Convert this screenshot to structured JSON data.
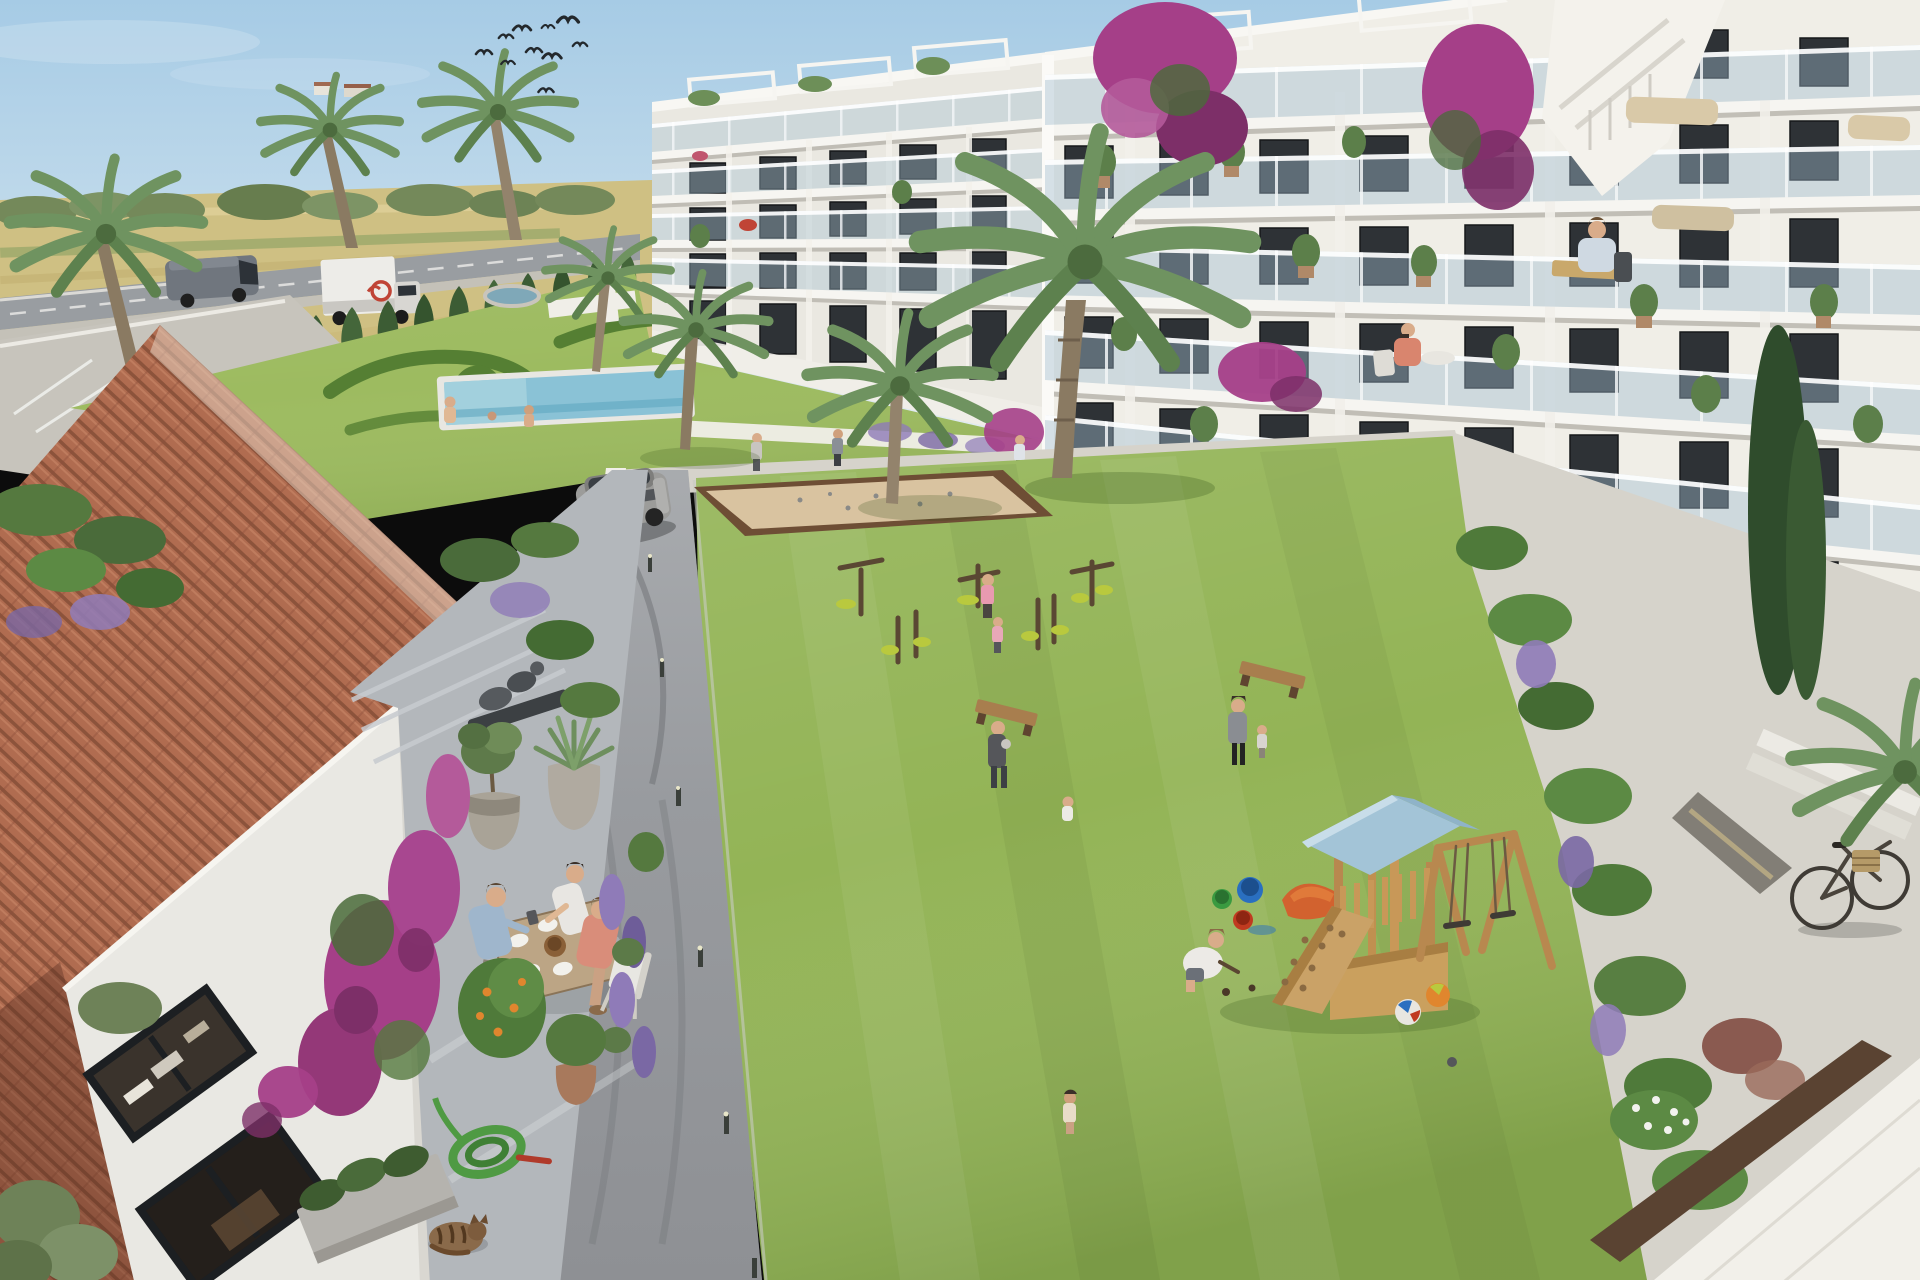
{
  "scene": {
    "type": "architectural-render",
    "setting": "aerial view of a modern white apartment complex courtyard with pool, playground and traditional tiled-roof house",
    "palette": {
      "sky": "#aed0e6",
      "skyHorizon": "#e6edf2",
      "field": "#cfc083",
      "fieldLight": "#decf9a",
      "treeline": "#74895a",
      "road": "#999da1",
      "parking": "#c7c4bc",
      "cypress": "#3c5c34",
      "gardenLawn": "#9dbb60",
      "hedge": "#557f33",
      "poolWater": "#8ac2d6",
      "facade": "#f0eee7",
      "facadeLeft": "#eae8e1",
      "slab": "#f8f7f3",
      "glass": "#a9c3d2",
      "windowDark": "#2e3236",
      "roofTile": "#b06c50",
      "wallWhite": "#e9e8e3",
      "terracePaving": "#b3b7bb",
      "pavingLight": "#d6d3cb",
      "courtLawn": "#93b456",
      "path": "#97999d",
      "sand": "#d9c3a0",
      "sandBorder": "#6e4e35",
      "wood": "#c0935c",
      "playRoof": "#a3c4d7",
      "slideOrange": "#d2622f",
      "bougainvillea": "#a53f88",
      "lavender": "#8f7bb8",
      "truckWhite": "#edece8",
      "vanGray": "#70767e",
      "carRed": "#c23527",
      "suvSilver": "#9c9c9a",
      "skin": "#d9ac8a",
      "catBrown": "#8a6a4a",
      "hoseGreen": "#4f9a43",
      "bikeDark": "#3f3b35",
      "statueGray": "#565a5e"
    },
    "objects": [
      {
        "name": "apartment-building-right"
      },
      {
        "name": "apartment-building-left-wing"
      },
      {
        "name": "traditional-house-terracotta-roof"
      },
      {
        "name": "swimming-pool"
      },
      {
        "name": "garden-pond"
      },
      {
        "name": "petanque-court"
      },
      {
        "name": "playground-tower-with-slide"
      },
      {
        "name": "swing-set"
      },
      {
        "name": "outdoor-gym-equipment"
      },
      {
        "name": "wooden-benches"
      },
      {
        "name": "dining-table-scene"
      },
      {
        "name": "statue"
      },
      {
        "name": "potted-olive-and-agave"
      },
      {
        "name": "garden-hose"
      },
      {
        "name": "sleeping-cat"
      },
      {
        "name": "bicycle-with-basket"
      },
      {
        "name": "palm-trees"
      },
      {
        "name": "cypress-hedge-row"
      },
      {
        "name": "bougainvillea"
      },
      {
        "name": "lavender-bushes"
      },
      {
        "name": "wheat-fields"
      },
      {
        "name": "country-road"
      },
      {
        "name": "parking-area"
      },
      {
        "name": "bird-flock"
      }
    ],
    "vehicles": [
      {
        "name": "gray-van"
      },
      {
        "name": "white-delivery-truck"
      },
      {
        "name": "red-car"
      },
      {
        "name": "silver-suv"
      },
      {
        "name": "bicycle"
      }
    ],
    "people": [
      {
        "location": "terrace-dining-table",
        "count": 3
      },
      {
        "location": "pool-area",
        "count": 3
      },
      {
        "location": "courtyard-lawn",
        "count": 8
      },
      {
        "location": "playground",
        "count": 1
      },
      {
        "location": "balconies",
        "count": 2
      },
      {
        "location": "walkways",
        "count": 4
      }
    ],
    "animals": [
      {
        "name": "sleeping-cat",
        "count": 1
      },
      {
        "name": "swallows",
        "count": 9
      }
    ]
  }
}
